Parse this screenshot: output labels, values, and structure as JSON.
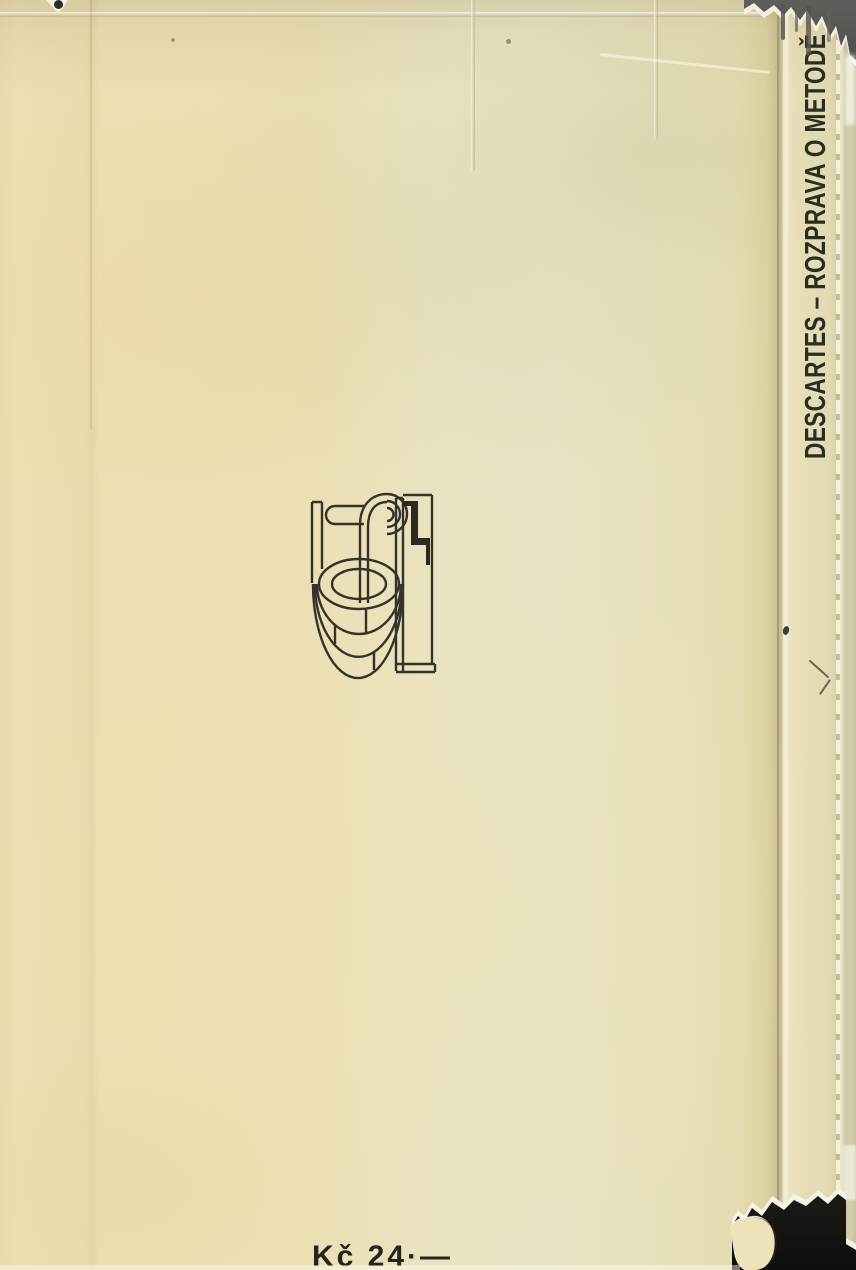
{
  "book": {
    "spine_title": "DESCARTES – ROZPRAVA O METODĚ",
    "price": "Kč 24·—",
    "logo": {
      "name": "well-with-pulley-publisher-emblem",
      "letter": "L"
    }
  },
  "colors": {
    "paper_warm": "#ecdfb3",
    "paper_pale": "#e9e3c2",
    "spine_paper": "#e2dab2",
    "fold_shadow": "#c0b589",
    "cloth_gray": "#514f4b",
    "cloth_black": "#131210",
    "ink": "#2c2b24"
  }
}
